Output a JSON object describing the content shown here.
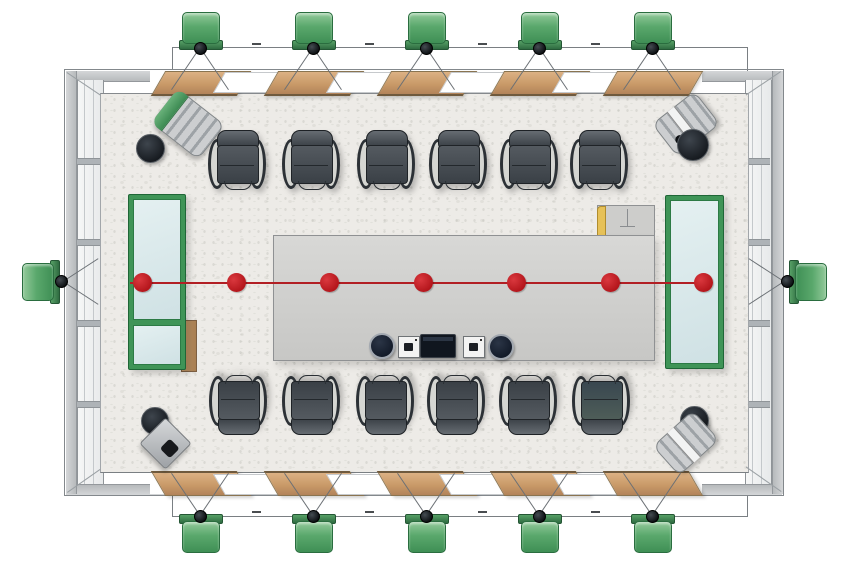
{
  "scene": {
    "type": "floor-plan",
    "view": "top-down",
    "labels": {
      "room": "conference room",
      "table": "conference table",
      "top_chair_row": "chair row top (6 chairs)",
      "bottom_chair_row": "chair row bottom (6 chairs)",
      "left_board": "glass board left",
      "right_board": "glass board right",
      "axis": "center reference line with markers"
    }
  },
  "counts": {
    "chairs_top": 6,
    "chairs_bottom": 6,
    "speakers_top": 5,
    "speakers_bottom": 5,
    "speakers_left": 1,
    "speakers_right": 1,
    "corner_units": 4,
    "red_markers": 7,
    "wood_panels_top": 5,
    "wood_panels_bottom": 5,
    "table_speakers": 2,
    "table_touch_pads": 2,
    "table_displays": 1
  },
  "colors": {
    "speaker_green": "#57a56b",
    "board_frame_green": "#3f9457",
    "wood": "#c89a68",
    "marker_red": "#bf1d23",
    "wall_gray": "#c3c6c8",
    "floor": "#edebe7",
    "table_gray": "#d0d0ce",
    "chair_dark": "#3e444a",
    "accent_yellow": "#e6c158"
  },
  "dimension_marks": {
    "top": 4,
    "bottom": 4,
    "legible": false
  }
}
